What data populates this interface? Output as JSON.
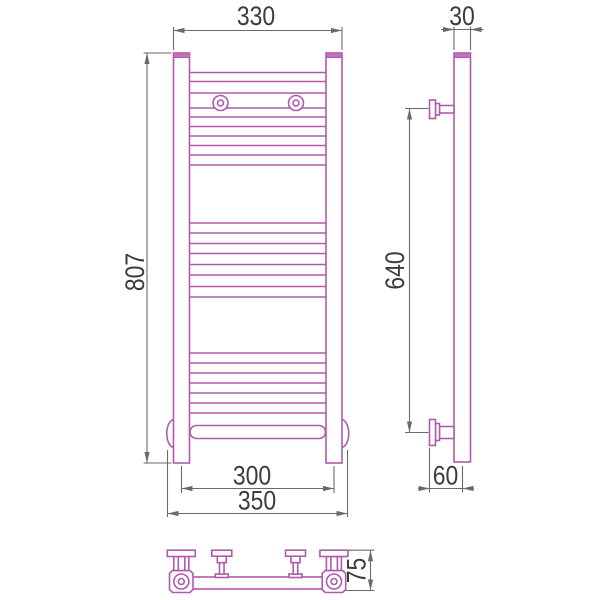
{
  "colors": {
    "background": "#ffffff",
    "product_line": "#b05aac",
    "product_fill": "#c56fbe",
    "dimension_line": "#6a6a6a",
    "text_color": "#3c3c3c"
  },
  "front_view": {
    "labels": {
      "top_width": "330",
      "height": "807",
      "bottom_centers": "300",
      "bottom_overall": "350"
    }
  },
  "side_view": {
    "labels": {
      "depth": "30",
      "bracket_span": "640",
      "wall_to_axis": "60"
    }
  },
  "bottom_view": {
    "labels": {
      "overall_depth": "75"
    }
  }
}
